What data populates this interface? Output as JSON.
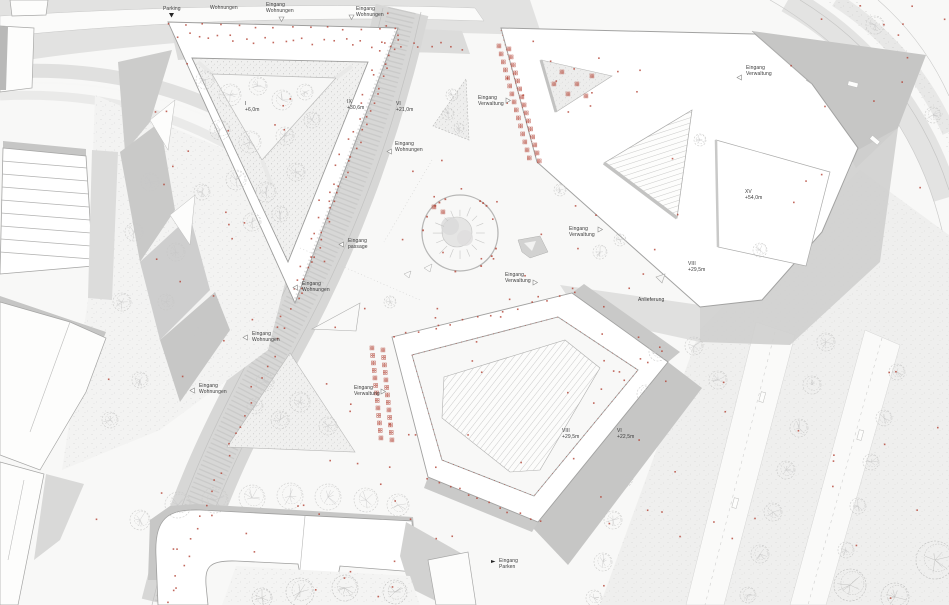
{
  "plan": {
    "colors": {
      "accent_red": "#b34234",
      "text": "#3b3b3b",
      "building_fill": "#ffffff",
      "street_gray": "#d8d8d7",
      "shadow_gray": "#c6c6c5"
    },
    "labels": [
      {
        "id": "parking",
        "line1": "Parking",
        "line2": "",
        "x": 163,
        "y": 6,
        "marker": "pin-black",
        "mdx": 6,
        "mdy": 7
      },
      {
        "id": "wohnungen-top",
        "line1": "Wohnungen",
        "line2": "",
        "x": 210,
        "y": 5,
        "marker": "none",
        "mdx": 0,
        "mdy": 0
      },
      {
        "id": "eingang-wohnungen-top-1",
        "line1": "Eingang",
        "line2": "Wohnungen",
        "x": 266,
        "y": 2,
        "marker": "tri-down",
        "mdx": 13,
        "mdy": 15,
        "cut": true
      },
      {
        "id": "eingang-wohnungen-top-2",
        "line1": "Eingang",
        "line2": "Wohnungen",
        "x": 356,
        "y": 6,
        "marker": "tri-down",
        "mdx": -7,
        "mdy": 9
      },
      {
        "id": "height-i",
        "line1": "I",
        "line2": "+6,0m",
        "x": 245,
        "y": 101,
        "marker": "none",
        "mdx": 0,
        "mdy": 0
      },
      {
        "id": "height-ix",
        "line1": "IX",
        "line2": "+30,6m",
        "x": 347,
        "y": 99,
        "marker": "none",
        "mdx": 0,
        "mdy": 0
      },
      {
        "id": "height-vi-21",
        "line1": "VI",
        "line2": "+21,0m",
        "x": 396,
        "y": 101,
        "marker": "none",
        "mdx": 0,
        "mdy": 0
      },
      {
        "id": "eingang-verwaltung-nw",
        "line1": "Eingang",
        "line2": "Verwaltung",
        "x": 478,
        "y": 95,
        "marker": "tri-right",
        "mdx": 28,
        "mdy": 3
      },
      {
        "id": "eingang-wohnungen-e",
        "line1": "Eingang",
        "line2": "Wohnungen",
        "x": 395,
        "y": 141,
        "marker": "tri-left",
        "mdx": -8,
        "mdy": 8
      },
      {
        "id": "eingang-verwaltung-ne",
        "line1": "Eingang",
        "line2": "Verwaltung",
        "x": 746,
        "y": 65,
        "marker": "tri-left",
        "mdx": -9,
        "mdy": 10
      },
      {
        "id": "height-xv",
        "line1": "XV",
        "line2": "+54,0m",
        "x": 745,
        "y": 189,
        "marker": "none",
        "mdx": 0,
        "mdy": 0
      },
      {
        "id": "height-viii-ne",
        "line1": "VIII",
        "line2": "+29,5m",
        "x": 688,
        "y": 261,
        "marker": "none",
        "mdx": 0,
        "mdy": 0
      },
      {
        "id": "eingang-verwaltung-c1",
        "line1": "Eingang",
        "line2": "Verwaltung",
        "x": 569,
        "y": 226,
        "marker": "tri-right",
        "mdx": 29,
        "mdy": 1
      },
      {
        "id": "eingang-verwaltung-c2",
        "line1": "Eingang",
        "line2": "Verwaltung",
        "x": 505,
        "y": 272,
        "marker": "tri-right",
        "mdx": 28,
        "mdy": 8
      },
      {
        "id": "eingang-passage",
        "line1": "Eingang",
        "line2": "passage",
        "x": 348,
        "y": 238,
        "marker": "tri-left",
        "mdx": -9,
        "mdy": 4
      },
      {
        "id": "eingang-wohnungen-c",
        "line1": "Eingang",
        "line2": "Wohnungen",
        "x": 302,
        "y": 281,
        "marker": "tri-left",
        "mdx": -9,
        "mdy": 4
      },
      {
        "id": "eingang-wohnungen-sw1",
        "line1": "Eingang",
        "line2": "Wohnungen",
        "x": 252,
        "y": 331,
        "marker": "tri-left",
        "mdx": -9,
        "mdy": 4
      },
      {
        "id": "eingang-wohnungen-sw2",
        "line1": "Eingang",
        "line2": "Wohnungen",
        "x": 199,
        "y": 383,
        "marker": "tri-left",
        "mdx": -9,
        "mdy": 5
      },
      {
        "id": "eingang-verwaltung-s",
        "line1": "Eingang",
        "line2": "Verwaltung",
        "x": 354,
        "y": 385,
        "marker": "tri-right",
        "mdx": 27,
        "mdy": 4
      },
      {
        "id": "anlieferung",
        "line1": "Anlieferung",
        "line2": "",
        "x": 638,
        "y": 297,
        "marker": "none",
        "mdx": 0,
        "mdy": 0
      },
      {
        "id": "height-viii-s",
        "line1": "VIII",
        "line2": "+29,5m",
        "x": 562,
        "y": 428,
        "marker": "none",
        "mdx": 0,
        "mdy": 0
      },
      {
        "id": "height-vi-22",
        "line1": "VI",
        "line2": "+22,5m",
        "x": 617,
        "y": 428,
        "marker": "none",
        "mdx": 0,
        "mdy": 0
      },
      {
        "id": "eingang-parken",
        "line1": "Eingang",
        "line2": "Parken",
        "x": 499,
        "y": 558,
        "marker": "flag-black",
        "mdx": -8,
        "mdy": 2
      }
    ]
  }
}
